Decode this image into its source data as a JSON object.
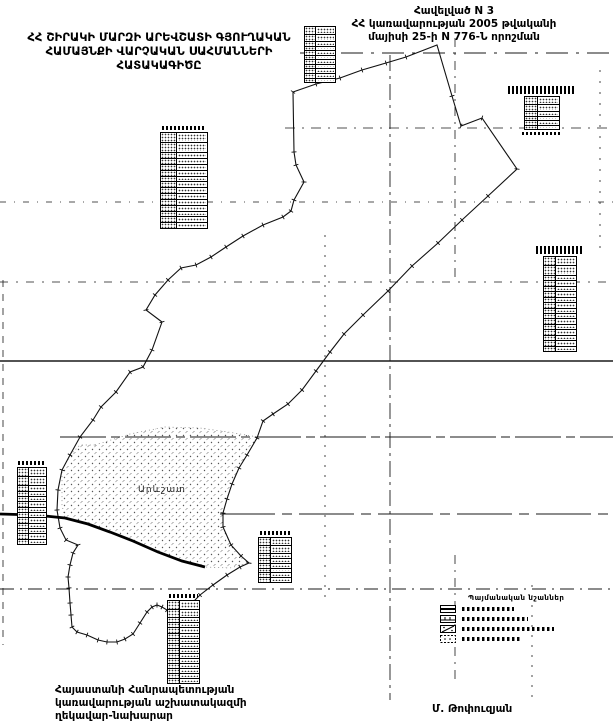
{
  "document": {
    "appendix": {
      "lines": [
        "Հավելված N 3",
        "ՀՀ կառավարության 2005 թվականի",
        "մայիսի 25-ի N 776-Ն որոշման"
      ]
    },
    "title": {
      "lines": [
        "ՀՀ ՇԻՐԱԿԻ ՄԱՐԶԻ ԱՐԵՎՇԱՏԻ ԳՅՈՒՂԱԿԱՆ",
        "ՀԱՄԱՅՆՔԻ  ՎԱՐՉԱԿԱՆ  ՍԱՀՄԱՆՆԵՐԻ",
        "ՀԱՏԱԿԱԳԻԾԸ"
      ]
    },
    "footer": {
      "lines": [
        "Հայաստանի Հանրապետության",
        "կառավարության աշխատակազմի",
        "ղեկավար-նախարար"
      ],
      "signature": "Մ. Թոփուզյան"
    }
  },
  "map": {
    "settlement_label": "Արևշատ",
    "ink_color": "#111111",
    "legend": {
      "title": "Պայմանական նշաններ",
      "items": [
        {
          "symbol": "community-boundary-symbol"
        },
        {
          "symbol": "settlement-boundary-symbol"
        },
        {
          "symbol": "settlement-built-area-symbol"
        },
        {
          "symbol": "agricultural-land-symbol"
        }
      ]
    },
    "tables": [
      {
        "name": "data-table-top",
        "rows": 11
      },
      {
        "name": "data-table-upper-left",
        "rows": 15
      },
      {
        "name": "data-table-upper-right",
        "rows": 6
      },
      {
        "name": "data-table-right",
        "rows": 16
      },
      {
        "name": "data-table-left",
        "rows": 13
      },
      {
        "name": "data-table-center",
        "rows": 8
      },
      {
        "name": "data-table-bottom",
        "rows": 15
      }
    ]
  }
}
